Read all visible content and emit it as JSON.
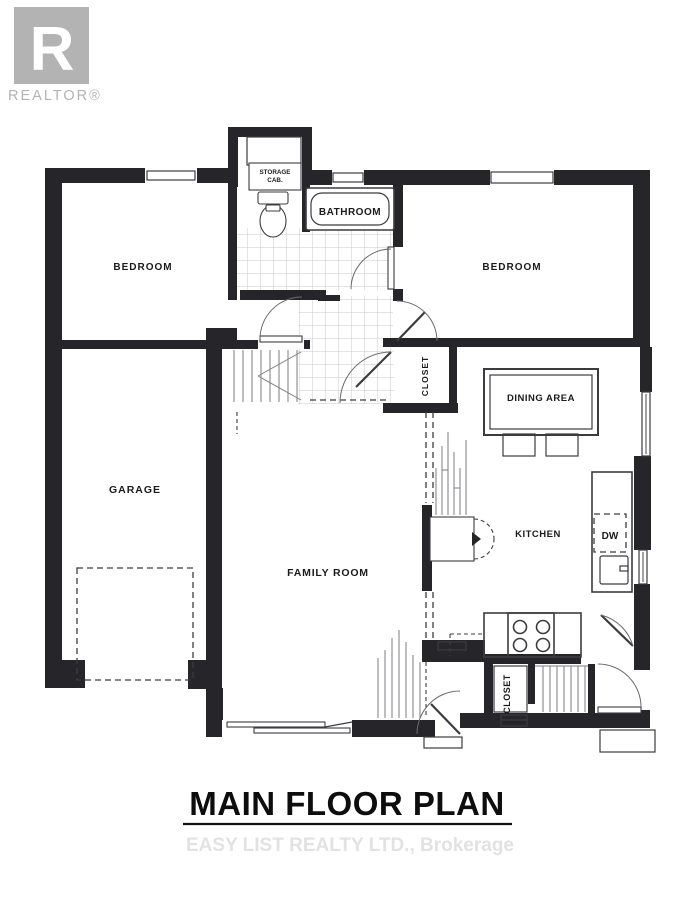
{
  "branding": {
    "logo_letter": "R",
    "logo_text": "REALTOR®"
  },
  "title": {
    "text": "MAIN FLOOR PLAN"
  },
  "watermark": {
    "text": "EASY LIST REALTY LTD., Brokerage"
  },
  "floorplan": {
    "labels": {
      "bedroom_left": "BEDROOM",
      "bedroom_right": "BEDROOM",
      "bathroom": "BATHROOM",
      "storage_line1": "STORAGE",
      "storage_line2": "CAB.",
      "hall_closet": "CLOSET",
      "rear_closet": "CLOSET",
      "dining_area": "DINING AREA",
      "kitchen": "KITCHEN",
      "dishwasher": "DW",
      "garage": "GARAGE",
      "family_room": "FAMILY ROOM"
    },
    "colors": {
      "wall": "#26262a",
      "line": "#3c3c40",
      "label": "#1b1b1b",
      "window_glyph": "#8a8a8a",
      "logo_gray": "#b3b3b3",
      "watermark_gray": "#e2e2e2"
    }
  }
}
